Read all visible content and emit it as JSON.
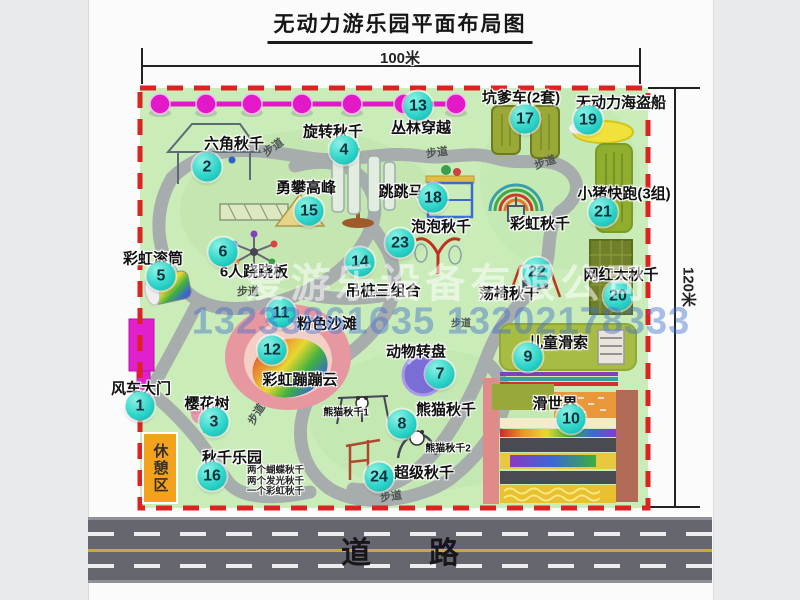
{
  "title": "无动力游乐园平面布局图",
  "dimensions": {
    "width_label": "100米",
    "height_label": "120米"
  },
  "road": {
    "label": "道路"
  },
  "watermark": {
    "company": "爱游乐设备有限公司",
    "phones": "13233861635 13202178333"
  },
  "path_label": "步道",
  "rest_area_label": "休憩区",
  "items": [
    {
      "num": "1",
      "label": "风车大门"
    },
    {
      "num": "2",
      "label": "六角秋千"
    },
    {
      "num": "3",
      "label": "樱花树"
    },
    {
      "num": "4",
      "label": "旋转秋千"
    },
    {
      "num": "5",
      "label": "彩虹滚筒"
    },
    {
      "num": "6",
      "label": "6人跷跷板"
    },
    {
      "num": "7",
      "label": "动物转盘"
    },
    {
      "num": "8",
      "label": "熊猫秋千"
    },
    {
      "num": "9",
      "label": "儿童滑索"
    },
    {
      "num": "10",
      "label": "滑世界"
    },
    {
      "num": "11",
      "label": "粉色沙滩"
    },
    {
      "num": "12",
      "label": "彩虹蹦蹦云"
    },
    {
      "num": "13",
      "label": "丛林穿越"
    },
    {
      "num": "14",
      "label": "吊桩三组合"
    },
    {
      "num": "15",
      "label": "勇攀高峰"
    },
    {
      "num": "16",
      "label": "秋千乐园"
    },
    {
      "num": "17",
      "label": "坑爹车(2套)"
    },
    {
      "num": "18",
      "label": "跳跳马"
    },
    {
      "num": "19",
      "label": "无动力海盗船"
    },
    {
      "num": "20",
      "label": "网红大秋千"
    },
    {
      "num": "21",
      "label": "小猪快跑(3组)"
    },
    {
      "num": "22",
      "label": "荡椅秋千"
    },
    {
      "num": "23",
      "label": "泡泡秋千"
    },
    {
      "num": "24",
      "label": "超级秋千"
    }
  ],
  "extras": {
    "rainbow_swing_label": "彩虹秋千",
    "panda_swing_1": "熊猫秋千1",
    "panda_swing_2": "熊猫秋千2",
    "swing_park_details": [
      "两个蝴蝶秋千",
      "两个发光秋千",
      "一个彩虹秋千"
    ]
  }
}
